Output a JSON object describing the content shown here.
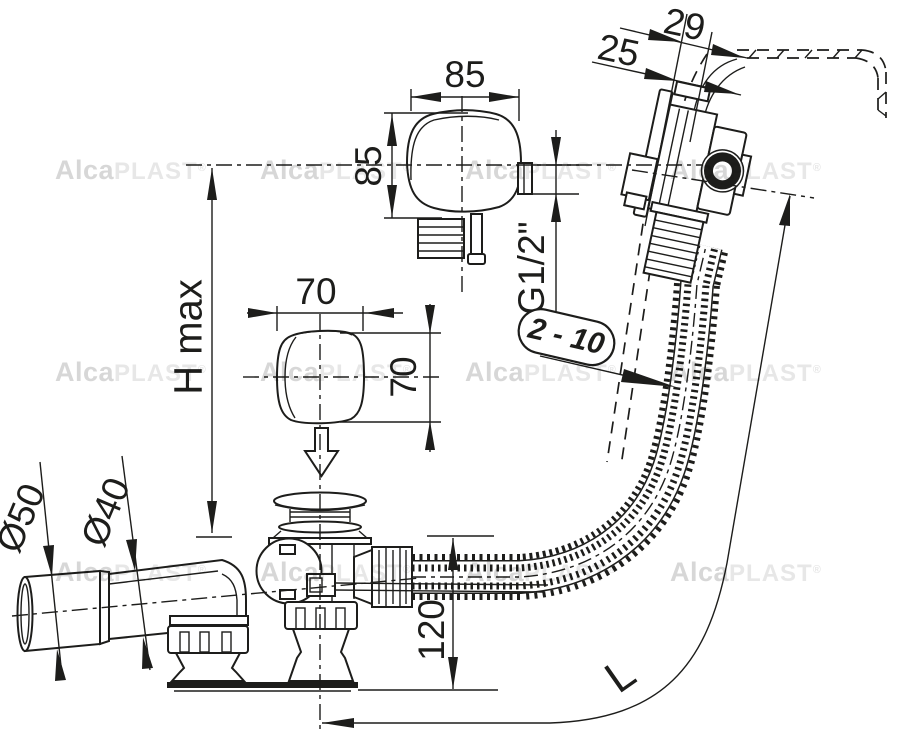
{
  "colors": {
    "line": "#1d1d1b",
    "background": "#ffffff",
    "watermark_dark": "#d7d7d7",
    "watermark_light": "#e7e7e7"
  },
  "watermark": {
    "alca": "Alca",
    "plast": "PLAST",
    "reg": "®"
  },
  "dimensions": {
    "overflow_width": "85",
    "overflow_height": "85",
    "trim_width": "70",
    "trim_height": "70",
    "rim_offset_outer": "29",
    "rim_offset_inner": "25",
    "thread": "G1/2\"",
    "panel_thickness_range": "2 - 10",
    "height_max": "H max",
    "outlet_diameter_large": "Ø50",
    "outlet_diameter_small": "Ø40",
    "drain_height": "120",
    "hose_length": "L"
  }
}
